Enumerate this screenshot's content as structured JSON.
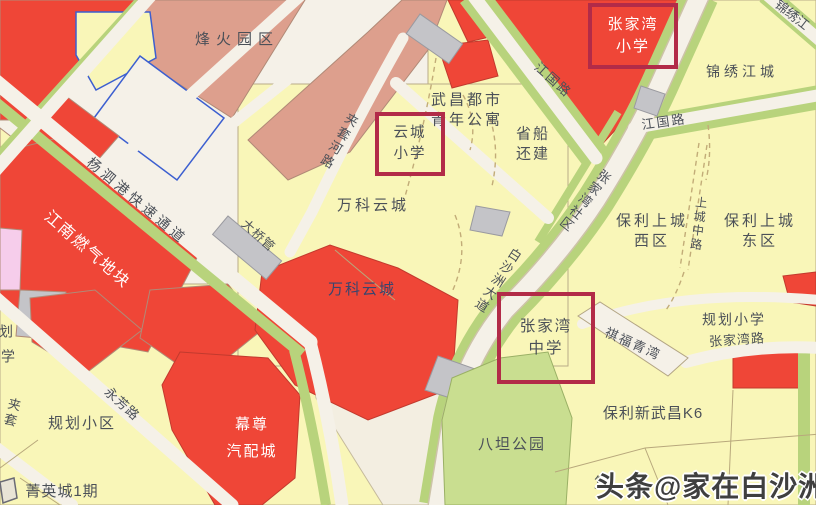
{
  "map": {
    "districts": {
      "fenghuo": "烽火园区",
      "jinxiu_jiangcheng": "锦绣江城",
      "wuchang_apartment": [
        "武昌都市",
        "青年公寓"
      ],
      "shengchuan": [
        "省船",
        "还建"
      ],
      "wanke_yuncheng_1": "万科云城",
      "wanke_yuncheng_2": "万科云城",
      "jiangnan_gas": "江南燃气地块",
      "zhangjiawan_shequ": "张家湾社区",
      "baoli_west": [
        "保利上城",
        "西区"
      ],
      "baoli_east": [
        "保利上城",
        "东区"
      ],
      "guihua_xiaoqu": "规划小区",
      "guihua_primary": "规划小学",
      "jingying": "菁英城1期",
      "muzun": [
        "幕尊",
        "汽配城"
      ],
      "batan_park": "八坦公园",
      "baoli_k6": "保利新武昌K6",
      "qifu": "祺福青湾",
      "daqiaoguan": "大桥管",
      "partial_fu": "复",
      "partial_hua": "划",
      "partial_xue": "学"
    },
    "schools": {
      "zjw_primary": [
        "张家湾",
        "小学"
      ],
      "yuncheng_primary": [
        "云城",
        "小学"
      ],
      "zjw_middle": [
        "张家湾",
        "中学"
      ]
    },
    "roads": {
      "jiangguo_w": "江国路",
      "jiangguo_e": "江国路",
      "jinxiu_partial": "锦绣江",
      "baishazhou": "白沙洲大道",
      "jiataohe": "夹套河路",
      "jiatao_partial": "夹套",
      "yangsigang": "杨泗港快速通道",
      "yongfang": "永芳路",
      "zhangjiawan_rd": "张家湾路",
      "shangcheng_rd": "上城中路"
    },
    "watermark": "头条@家在白沙洲",
    "colors": {
      "parcel_red": "#ef4637",
      "parcel_yellow": "#f9f6b8",
      "parcel_salmon": "#dd9f8d",
      "green_strip": "#b8d37c",
      "park_green": "#c9de90",
      "gray_parcel": "#c4c4c8",
      "pink_parcel": "#f6cdeb",
      "road": "#f5f1e8",
      "highlight_box": "#b22b48",
      "label_text": "#4b5058"
    }
  }
}
